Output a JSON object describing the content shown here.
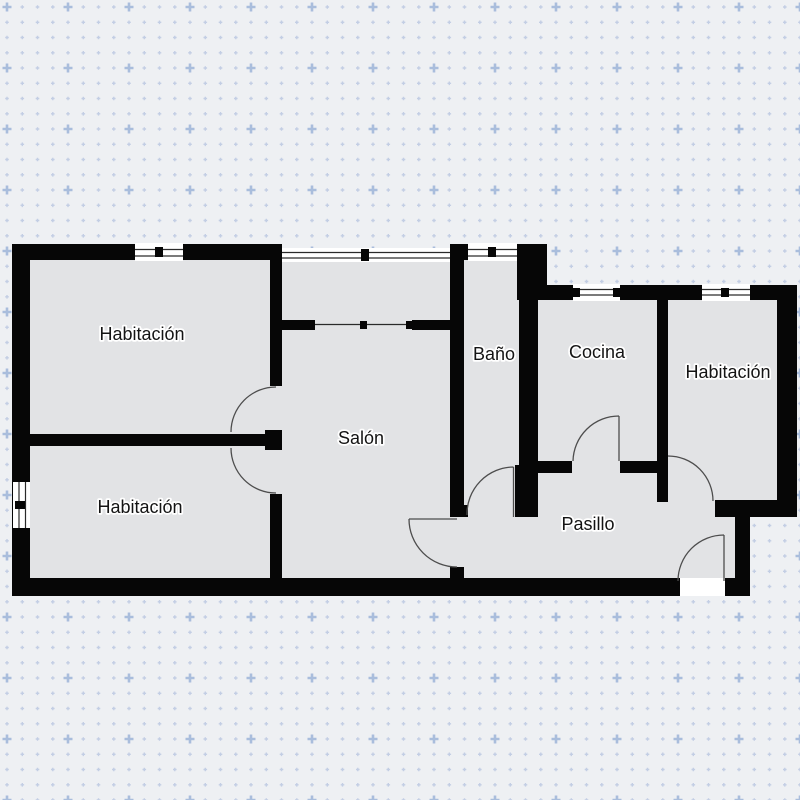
{
  "plan": {
    "title": "floor-plan",
    "rooms": [
      {
        "id": "habitacion-1",
        "label": "Habitación"
      },
      {
        "id": "habitacion-2",
        "label": "Habitación"
      },
      {
        "id": "salon",
        "label": "Salón"
      },
      {
        "id": "bano",
        "label": "Baño"
      },
      {
        "id": "cocina",
        "label": "Cocina"
      },
      {
        "id": "habitacion-3",
        "label": "Habitación"
      },
      {
        "id": "pasillo",
        "label": "Pasillo"
      }
    ],
    "colors": {
      "background": "#eef0f3",
      "grid_dot": "#c3cee4",
      "grid_accent": "#a9bddc",
      "floor": "#e2e3e5",
      "wall": "#060606",
      "door_arc": "#4d4d4d"
    }
  }
}
